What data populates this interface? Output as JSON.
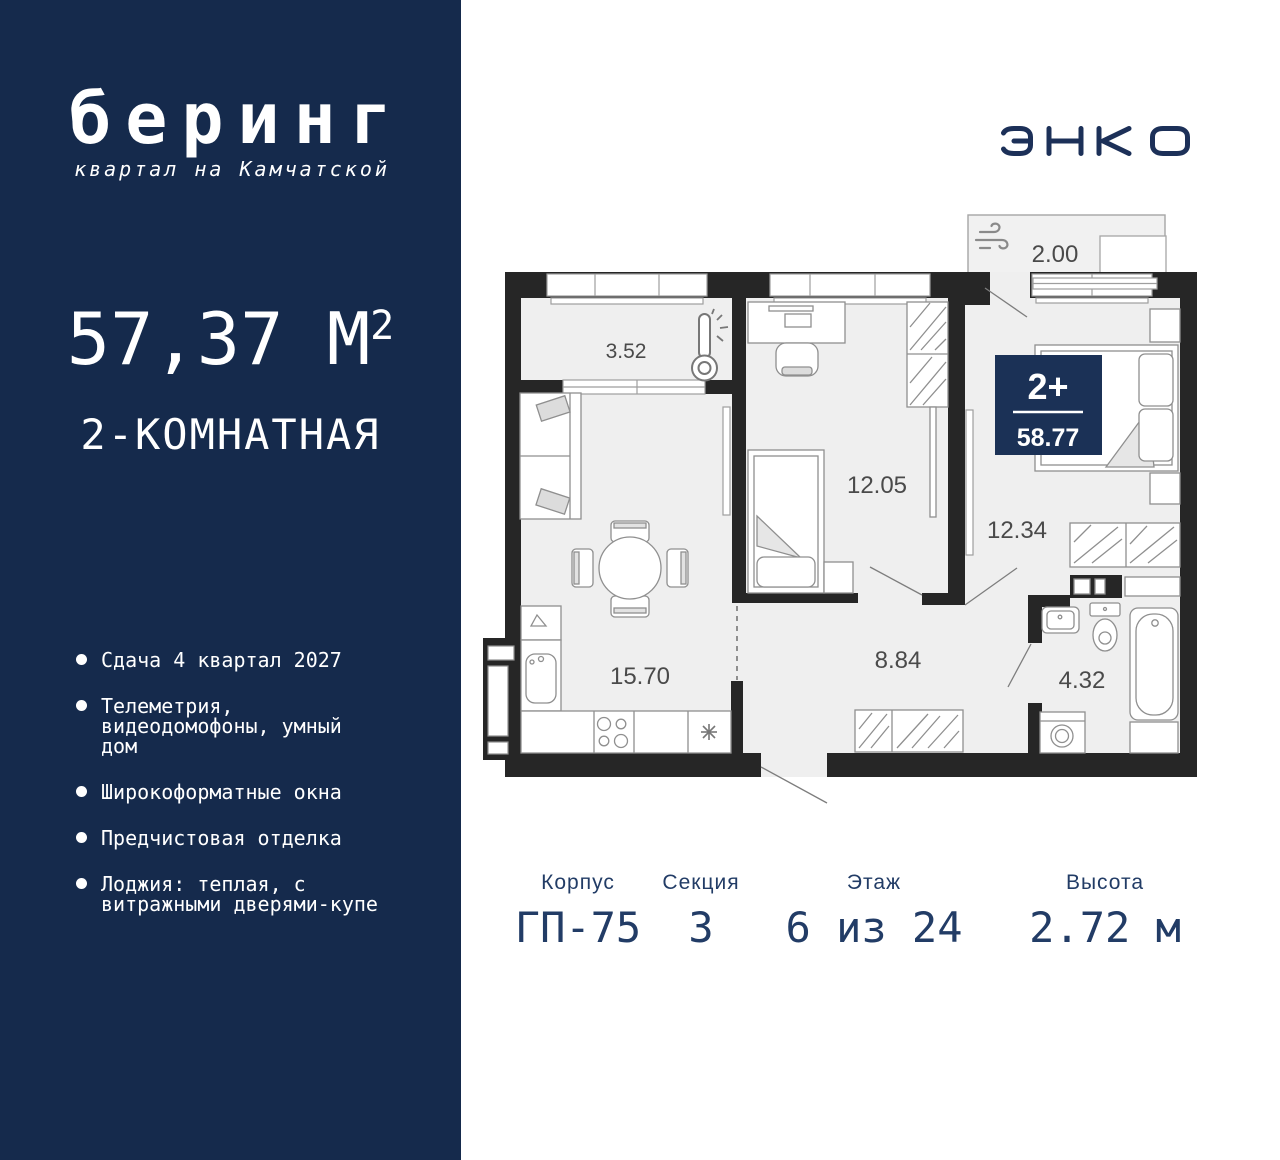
{
  "sidebar": {
    "logo": {
      "title": "беринг",
      "subtitle": "квартал на Камчатской"
    },
    "area": {
      "value": "57,37 М",
      "sup": "2"
    },
    "type_label": "2-КОМНАТНАЯ",
    "features": [
      "Сдача 4 квартал 2027",
      "Телеметрия, видеодомофоны, умный дом",
      "Широкоформатные окна",
      "Предчистовая отделка",
      "Лоджия: теплая, с витражными дверями-купе"
    ]
  },
  "developer": {
    "logo_text": "ЭНКО"
  },
  "plan": {
    "badge": {
      "rooms": "2+",
      "area": "58.77"
    },
    "rooms": [
      {
        "id": "loggia-small",
        "area": "3.52"
      },
      {
        "id": "bedroom",
        "area": "12.05"
      },
      {
        "id": "master-bedroom",
        "area": "12.34"
      },
      {
        "id": "loggia-large",
        "area": "2.00"
      },
      {
        "id": "kitchen-living",
        "area": "15.70"
      },
      {
        "id": "hallway",
        "area": "8.84"
      },
      {
        "id": "bathroom",
        "area": "4.32"
      }
    ],
    "icons": [
      "thermometer-icon",
      "wind-icon"
    ]
  },
  "info": {
    "columns": [
      {
        "label": "Корпус",
        "value": "ГП-75"
      },
      {
        "label": "Секция",
        "value": "3"
      },
      {
        "label": "Этаж",
        "value": "6 из 24"
      },
      {
        "label": "Высота",
        "value": "2.72 м"
      }
    ]
  },
  "colors": {
    "sidebar_navy": "#152A4C",
    "badge_navy": "#1B3156",
    "info_text": "#223C66",
    "logo_navy": "#1C3058",
    "walls": "#262626"
  }
}
